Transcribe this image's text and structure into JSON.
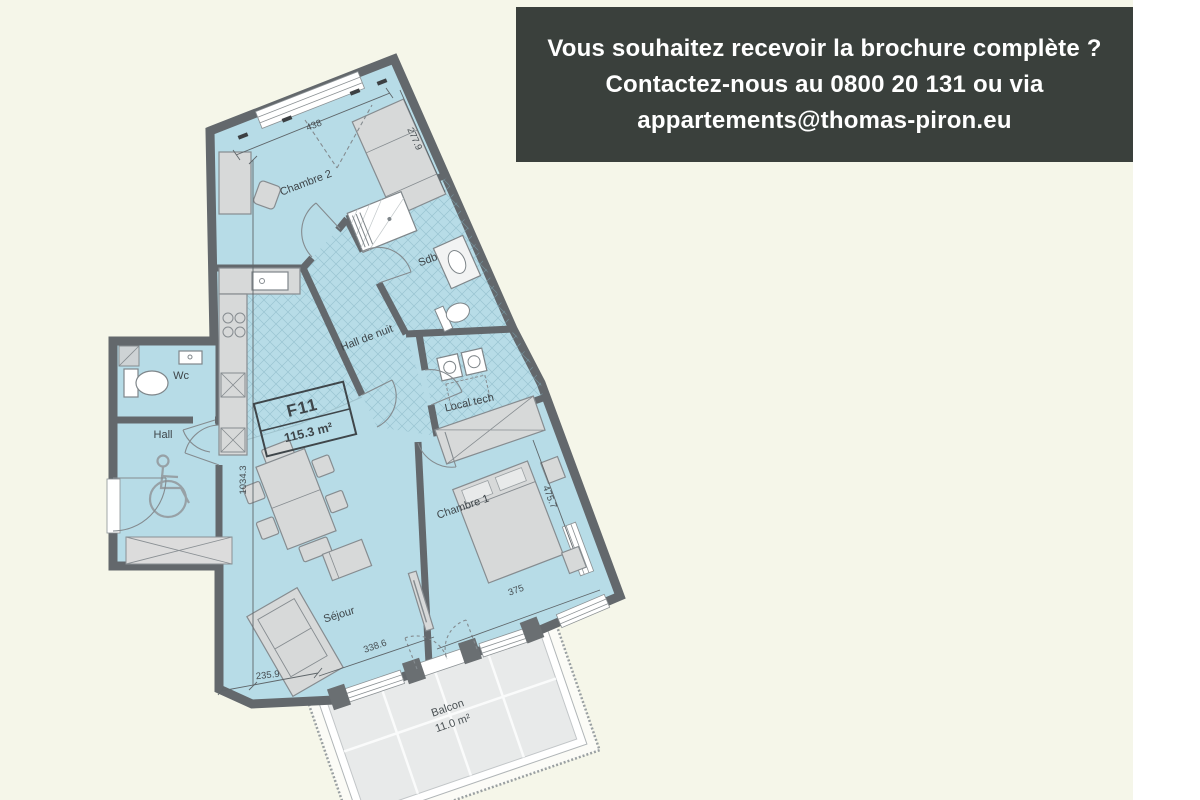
{
  "banner": {
    "line1": "Vous souhaitez recevoir la brochure complète ?",
    "line2": "Contactez-nous au 0800 20 131 ou via",
    "line3": "appartements@thomas-piron.eu",
    "bg_color": "#3a403c",
    "text_color": "#ffffff"
  },
  "plan": {
    "unit": {
      "code": "F11",
      "area": "115.3 m²"
    },
    "rooms": {
      "chambre2": "Chambre 2",
      "sdb": "Sdb",
      "hall_de_nuit": "Hall de nuit",
      "local_tech": "Local tech",
      "chambre1": "Chambre 1",
      "sejour": "Séjour",
      "wc": "Wc",
      "hall": "Hall",
      "balcon": "Balcon",
      "balcon_area": "11.0 m²"
    },
    "dimensions": {
      "chambre2_width": "438",
      "chambre2_depth": "277.9",
      "total_depth": "1034.3",
      "chambre1_depth": "475.7",
      "chambre1_width": "375",
      "sejour_width": "338.6",
      "sejour_left": "235.9"
    },
    "colors": {
      "room_fill": "#b7dce7",
      "wall": "#63686c",
      "background": "#f5f6e9",
      "furniture": "#d7d9d9"
    }
  }
}
